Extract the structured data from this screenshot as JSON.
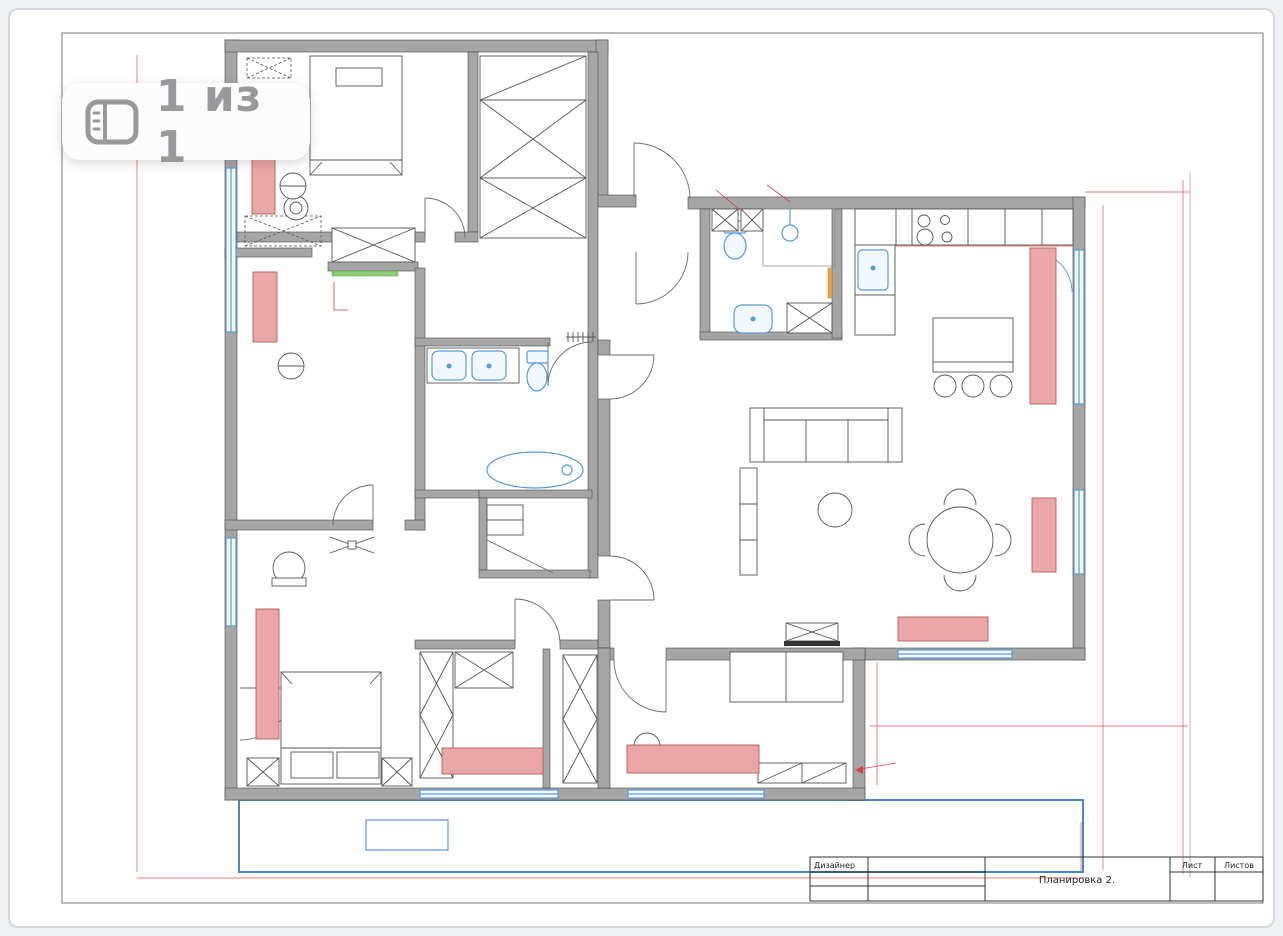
{
  "badge": {
    "icon": "gallery-pages-icon",
    "text": "1 из 1"
  },
  "title_block": {
    "designer_label": "Дизайнер",
    "drawing_title": "Планировка 2.",
    "sheet_label": "Лист",
    "sheets_label": "Листов"
  },
  "colors": {
    "dimension_red": "#d94040",
    "wall_gray": "#a6a6a6",
    "fixture_blue": "#5b9bd5",
    "furniture_pink": "#eba7a7",
    "climbing_wall_green": "#8fc97a",
    "accent_orange": "#eda34f",
    "terrace_blue": "#4a86c8"
  },
  "plan": {
    "labels": [
      {
        "x": 712,
        "y": 177,
        "t": "Инсталляция",
        "cls": "note"
      },
      {
        "x": 712,
        "y": 186,
        "t": "h=1200",
        "cls": "note"
      },
      {
        "x": 765,
        "y": 180,
        "t": "Полочки",
        "cls": "note"
      },
      {
        "x": 352,
        "y": 313,
        "t": "Скалодром",
        "cls": "note",
        "anchor": "start"
      },
      {
        "x": 1034,
        "y": 223,
        "t": "СВЧ",
        "cls": "note-red",
        "anchor": "start"
      },
      {
        "x": 1034,
        "y": 232,
        "t": "ДШ",
        "cls": "note-red",
        "anchor": "start"
      },
      {
        "x": 1007,
        "y": 227,
        "t": "x",
        "cls": "note-red"
      },
      {
        "x": 872,
        "y": 313,
        "t": "ПМ",
        "cls": "note",
        "r": "v"
      },
      {
        "x": 498,
        "y": 520,
        "t": "СМ",
        "cls": "note",
        "r": "v"
      },
      {
        "x": 512,
        "y": 520,
        "t": "ШМ",
        "cls": "note",
        "r": "v"
      },
      {
        "x": 406,
        "y": 841,
        "t": "S= 10",
        "cls": "note-blue"
      },
      {
        "x": 899,
        "y": 758,
        "t": "Стеллаж под",
        "cls": "note",
        "anchor": "start"
      },
      {
        "x": 899,
        "y": 768,
        "t": "Кубки",
        "cls": "note",
        "anchor": "start"
      }
    ],
    "dimensions": [
      {
        "x": 135,
        "y": 470,
        "t": "14480",
        "r": "v"
      },
      {
        "x": 172,
        "y": 875,
        "t": "1970"
      },
      {
        "x": 655,
        "y": 875,
        "t": "6820"
      },
      {
        "x": 935,
        "y": 875,
        "t": "3380"
      },
      {
        "x": 1078,
        "y": 850,
        "t": "1150",
        "r": "v"
      },
      {
        "x": 1140,
        "y": 189,
        "t": "1968"
      },
      {
        "x": 1110,
        "y": 395,
        "t": "8910",
        "r": "v"
      },
      {
        "x": 1176,
        "y": 455,
        "t": "10280",
        "r": "v"
      },
      {
        "x": 1018,
        "y": 724,
        "t": "5880"
      },
      {
        "x": 873,
        "y": 706,
        "t": "1370",
        "r": "v"
      },
      {
        "x": 363,
        "y": 50,
        "t": "1800"
      },
      {
        "x": 273,
        "y": 64,
        "t": "1000"
      },
      {
        "x": 442,
        "y": 64,
        "t": "1000"
      },
      {
        "x": 568,
        "y": 60,
        "t": "777"
      },
      {
        "x": 465,
        "y": 80,
        "t": "500",
        "r": "v"
      },
      {
        "x": 323,
        "y": 115,
        "t": "2240",
        "r": "v"
      },
      {
        "x": 358,
        "y": 160,
        "t": "1600"
      },
      {
        "x": 484,
        "y": 108,
        "t": "775",
        "r": "v"
      },
      {
        "x": 583,
        "y": 118,
        "t": "1475",
        "r": "v"
      },
      {
        "x": 494,
        "y": 145,
        "t": "700",
        "r": "v"
      },
      {
        "x": 508,
        "y": 157,
        "t": "2675",
        "r": "v"
      },
      {
        "x": 545,
        "y": 160,
        "t": "950"
      },
      {
        "x": 334,
        "y": 190,
        "t": "625",
        "r": "v"
      },
      {
        "x": 402,
        "y": 205,
        "t": "1020",
        "r": "v"
      },
      {
        "x": 652,
        "y": 199,
        "t": "986"
      },
      {
        "x": 332,
        "y": 231,
        "t": "600",
        "r": "v"
      },
      {
        "x": 278,
        "y": 253,
        "t": "1260"
      },
      {
        "x": 305,
        "y": 266,
        "t": "500",
        "r": "v"
      },
      {
        "x": 375,
        "y": 258,
        "t": "1452"
      },
      {
        "x": 362,
        "y": 284,
        "t": "1260"
      },
      {
        "x": 410,
        "y": 300,
        "t": "800",
        "r": "v"
      },
      {
        "x": 428,
        "y": 298,
        "t": "900",
        "r": "v"
      },
      {
        "x": 472,
        "y": 304,
        "t": "150"
      },
      {
        "x": 475,
        "y": 325,
        "t": "610",
        "r": "v"
      },
      {
        "x": 448,
        "y": 237,
        "t": "800"
      },
      {
        "x": 455,
        "y": 252,
        "t": "900"
      },
      {
        "x": 432,
        "y": 312,
        "t": "1400"
      },
      {
        "x": 500,
        "y": 322,
        "t": "1000"
      },
      {
        "x": 650,
        "y": 312,
        "t": "1344"
      },
      {
        "x": 262,
        "y": 256,
        "t": "1300"
      },
      {
        "x": 240,
        "y": 273,
        "t": "500",
        "r": "v"
      },
      {
        "x": 253,
        "y": 480,
        "t": "1280",
        "r": "v"
      },
      {
        "x": 245,
        "y": 521,
        "t": "600"
      },
      {
        "x": 322,
        "y": 521,
        "t": "1520"
      },
      {
        "x": 452,
        "y": 521,
        "t": "1070"
      },
      {
        "x": 466,
        "y": 367,
        "t": "1660"
      },
      {
        "x": 508,
        "y": 361,
        "t": "500",
        "r": "v"
      },
      {
        "x": 518,
        "y": 357,
        "t": "955",
        "r": "v"
      },
      {
        "x": 543,
        "y": 353,
        "t": "800"
      },
      {
        "x": 620,
        "y": 355,
        "t": "730",
        "r": "v"
      },
      {
        "x": 480,
        "y": 413,
        "t": "1270",
        "r": "v"
      },
      {
        "x": 414,
        "y": 407,
        "t": "500",
        "r": "v"
      },
      {
        "x": 618,
        "y": 405,
        "t": "800",
        "r": "v"
      },
      {
        "x": 425,
        "y": 480,
        "t": "1490",
        "r": "v"
      },
      {
        "x": 535,
        "y": 484,
        "t": "2000"
      },
      {
        "x": 584,
        "y": 466,
        "t": "500",
        "r": "v"
      },
      {
        "x": 506,
        "y": 504,
        "t": "600"
      },
      {
        "x": 480,
        "y": 518,
        "t": "540",
        "r": "v"
      },
      {
        "x": 521,
        "y": 517,
        "t": "600",
        "r": "v"
      },
      {
        "x": 509,
        "y": 537,
        "t": "460"
      },
      {
        "x": 517,
        "y": 553,
        "t": "610",
        "r": "v"
      },
      {
        "x": 506,
        "y": 573,
        "t": "605"
      },
      {
        "x": 555,
        "y": 573,
        "t": "1260"
      },
      {
        "x": 588,
        "y": 529,
        "t": "800",
        "r": "v"
      },
      {
        "x": 700,
        "y": 199,
        "t": "680"
      },
      {
        "x": 753,
        "y": 199,
        "t": "250"
      },
      {
        "x": 790,
        "y": 199,
        "t": "1260"
      },
      {
        "x": 823,
        "y": 230,
        "t": "1000",
        "r": "v"
      },
      {
        "x": 717,
        "y": 279,
        "t": "700",
        "r": "v"
      },
      {
        "x": 695,
        "y": 279,
        "t": "800",
        "r": "v"
      },
      {
        "x": 806,
        "y": 283,
        "t": "812",
        "r": "v"
      },
      {
        "x": 833,
        "y": 288,
        "t": "500",
        "r": "v"
      },
      {
        "x": 755,
        "y": 337,
        "t": "1160"
      },
      {
        "x": 808,
        "y": 337,
        "t": "800"
      },
      {
        "x": 826,
        "y": 320,
        "t": "500",
        "r": "v"
      },
      {
        "x": 875,
        "y": 243,
        "t": "660"
      },
      {
        "x": 917,
        "y": 243,
        "t": "600"
      },
      {
        "x": 955,
        "y": 243,
        "t": "660"
      },
      {
        "x": 993,
        "y": 243,
        "t": "600"
      },
      {
        "x": 1031,
        "y": 243,
        "t": "600"
      },
      {
        "x": 1069,
        "y": 228,
        "t": "600",
        "r": "v"
      },
      {
        "x": 893,
        "y": 252,
        "t": "350",
        "r": "v"
      },
      {
        "x": 893,
        "y": 270,
        "t": "600",
        "r": "v"
      },
      {
        "x": 893,
        "y": 303,
        "t": "600",
        "r": "v"
      },
      {
        "x": 893,
        "y": 330,
        "t": "350",
        "r": "v"
      },
      {
        "x": 930,
        "y": 278,
        "t": "1400",
        "r": "v"
      },
      {
        "x": 908,
        "y": 313,
        "t": "810"
      },
      {
        "x": 1040,
        "y": 312,
        "t": "810"
      },
      {
        "x": 972,
        "y": 324,
        "t": "1500"
      },
      {
        "x": 1009,
        "y": 339,
        "t": "800",
        "r": "v"
      },
      {
        "x": 1009,
        "y": 371,
        "t": "300",
        "r": "v"
      },
      {
        "x": 853,
        "y": 380,
        "t": "1240",
        "r": "v"
      },
      {
        "x": 825,
        "y": 418,
        "t": "2700"
      },
      {
        "x": 755,
        "y": 437,
        "t": "950",
        "r": "v"
      },
      {
        "x": 962,
        "y": 440,
        "t": "2340",
        "r": "v"
      },
      {
        "x": 810,
        "y": 547,
        "t": "2970",
        "r": "v"
      },
      {
        "x": 950,
        "y": 527,
        "t": "Ø1200",
        "r": 45
      },
      {
        "x": 984,
        "y": 600,
        "t": "1310",
        "r": "v"
      },
      {
        "x": 668,
        "y": 465,
        "t": "1360"
      },
      {
        "x": 722,
        "y": 520,
        "t": "2200",
        "r": "v"
      },
      {
        "x": 733,
        "y": 568,
        "t": "800",
        "r": "v"
      },
      {
        "x": 738,
        "y": 605,
        "t": "900",
        "r": "v"
      },
      {
        "x": 806,
        "y": 625,
        "t": "2600"
      },
      {
        "x": 268,
        "y": 566,
        "t": "1000",
        "r": "v"
      },
      {
        "x": 260,
        "y": 585,
        "t": "600"
      },
      {
        "x": 379,
        "y": 602,
        "t": "2470",
        "r": "v"
      },
      {
        "x": 290,
        "y": 729,
        "t": "2000",
        "r": "v"
      },
      {
        "x": 330,
        "y": 772,
        "t": "1800"
      },
      {
        "x": 262,
        "y": 776,
        "t": "500",
        "r": "v"
      },
      {
        "x": 283,
        "y": 774,
        "t": "700",
        "r": "v"
      },
      {
        "x": 383,
        "y": 774,
        "t": "700",
        "r": "v"
      },
      {
        "x": 400,
        "y": 777,
        "t": "600"
      },
      {
        "x": 537,
        "y": 641,
        "t": "900"
      },
      {
        "x": 435,
        "y": 656,
        "t": "600"
      },
      {
        "x": 478,
        "y": 655,
        "t": "1000"
      },
      {
        "x": 537,
        "y": 657,
        "t": "800"
      },
      {
        "x": 580,
        "y": 656,
        "t": "600"
      },
      {
        "x": 645,
        "y": 656,
        "t": "900"
      },
      {
        "x": 613,
        "y": 685,
        "t": "1150",
        "r": "v"
      },
      {
        "x": 424,
        "y": 695,
        "t": "1600",
        "r": "v"
      },
      {
        "x": 561,
        "y": 715,
        "t": "2355",
        "r": "v"
      },
      {
        "x": 593,
        "y": 712,
        "t": "2080",
        "r": "v"
      },
      {
        "x": 424,
        "y": 764,
        "t": "755",
        "r": "v"
      },
      {
        "x": 431,
        "y": 778,
        "t": "400"
      },
      {
        "x": 645,
        "y": 750,
        "t": "1200",
        "r": "v"
      },
      {
        "x": 612,
        "y": 718,
        "t": "250"
      },
      {
        "x": 625,
        "y": 718,
        "t": "250"
      },
      {
        "x": 640,
        "y": 641,
        "t": "800"
      },
      {
        "x": 643,
        "y": 657,
        "t": "500"
      },
      {
        "x": 700,
        "y": 657,
        "t": "1260"
      },
      {
        "x": 740,
        "y": 634,
        "t": "350",
        "r": "v"
      },
      {
        "x": 788,
        "y": 662,
        "t": "2000"
      },
      {
        "x": 742,
        "y": 677,
        "t": "900",
        "r": "v"
      },
      {
        "x": 836,
        "y": 732,
        "t": "1180",
        "r": "v"
      },
      {
        "x": 639,
        "y": 752,
        "t": "1900",
        "r": "v"
      },
      {
        "x": 781,
        "y": 760,
        "t": "750"
      },
      {
        "x": 824,
        "y": 760,
        "t": "750"
      },
      {
        "x": 765,
        "y": 775,
        "t": "300",
        "r": "v"
      }
    ]
  }
}
